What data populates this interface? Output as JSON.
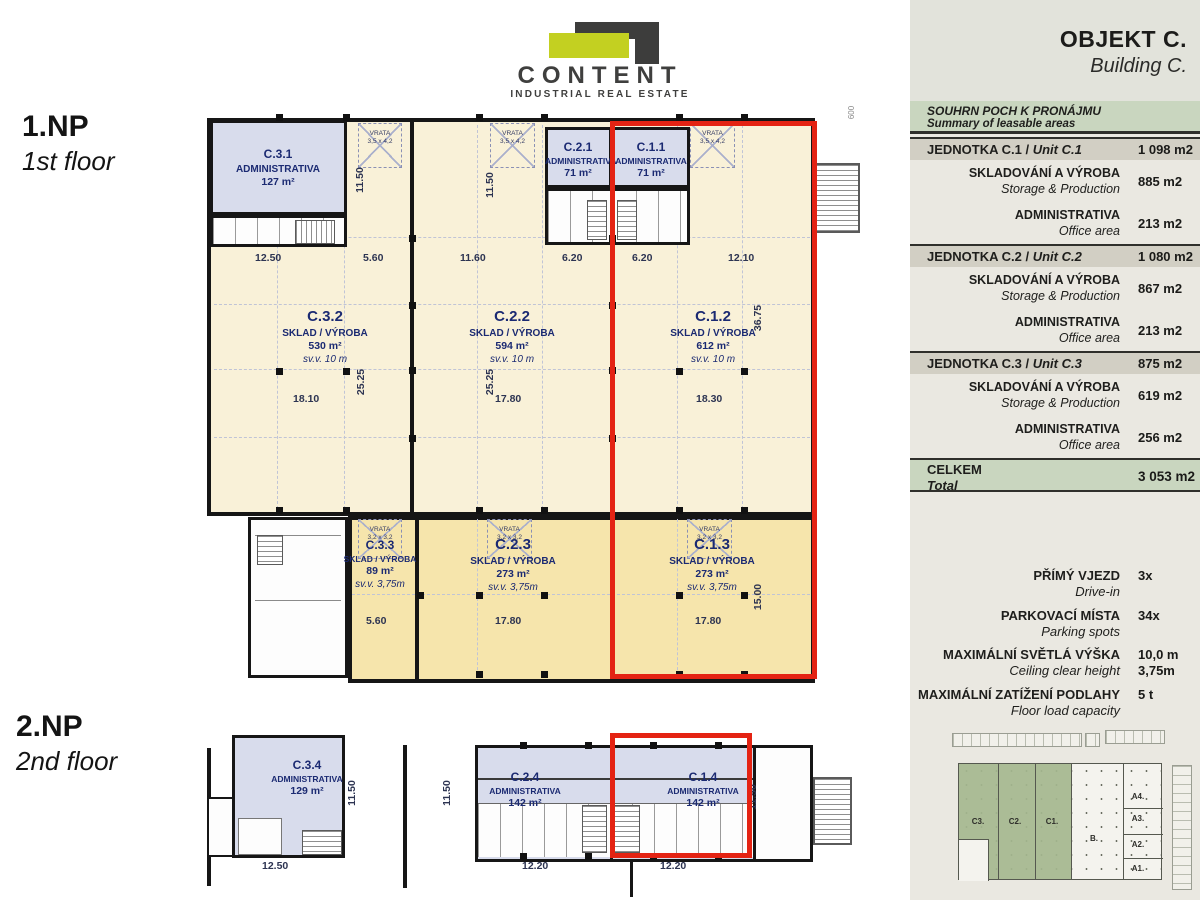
{
  "logo": {
    "name": "CONTENT",
    "tagline": "INDUSTRIAL REAL ESTATE"
  },
  "floor1": {
    "code": "1.NP",
    "label": "1st floor"
  },
  "floor2": {
    "code": "2.NP",
    "label": "2nd floor"
  },
  "plan1": {
    "rooms": {
      "c31": {
        "code": "C.3.1",
        "type": "ADMINISTRATIVA",
        "area": "127 m²"
      },
      "c21": {
        "code": "C.2.1",
        "type": "ADMINISTRATIVA",
        "area": "71 m²"
      },
      "c11": {
        "code": "C.1.1",
        "type": "ADMINISTRATIVA",
        "area": "71 m²"
      },
      "c32": {
        "code": "C.3.2",
        "type": "SKLAD / VÝROBA",
        "area": "530 m²",
        "height": "sv.v. 10 m"
      },
      "c22": {
        "code": "C.2.2",
        "type": "SKLAD / VÝROBA",
        "area": "594 m²",
        "height": "sv.v. 10 m"
      },
      "c12": {
        "code": "C.1.2",
        "type": "SKLAD / VÝROBA",
        "area": "612 m²",
        "height": "sv.v. 10 m"
      },
      "c33": {
        "code": "C.3.3",
        "type": "SKLAD / VÝROBA",
        "area": "89 m²",
        "height": "sv.v. 3,75m"
      },
      "c23": {
        "code": "C.2.3",
        "type": "SKLAD / VÝROBA",
        "area": "273 m²",
        "height": "sv.v. 3,75m"
      },
      "c13": {
        "code": "C.1.3",
        "type": "SKLAD / VÝROBA",
        "area": "273 m²",
        "height": "sv.v. 3,75m"
      }
    },
    "doors": {
      "label": "VRATA",
      "size_top": "3,5 x 4,2",
      "size_bottom": "3,2 x 3,2"
    },
    "dims": {
      "w1": "12.50",
      "w2": "5.60",
      "w3": "11.60",
      "w4": "6.20",
      "w5": "6.20",
      "w6": "12.10",
      "m1": "18.10",
      "m2": "17.80",
      "m3": "18.30",
      "b1": "5.60",
      "b2": "17.80",
      "b3": "17.80",
      "v1": "11.50",
      "v2": "11.50",
      "v3": "25.25",
      "v4": "25.25",
      "v5": "36.75",
      "v6": "15.00",
      "e1": "600"
    }
  },
  "plan2": {
    "rooms": {
      "c34": {
        "code": "C.3.4",
        "type": "ADMINISTRATIVA",
        "area": "129 m²"
      },
      "c24": {
        "code": "C.2.4",
        "type": "ADMINISTRATIVA",
        "area": "142 m²"
      },
      "c14": {
        "code": "C.1.4",
        "type": "ADMINISTRATIVA",
        "area": "142 m²"
      }
    },
    "dims": {
      "b1": "12.50",
      "b2": "12.20",
      "b3": "12.20",
      "v1": "11.50",
      "v2": "11.50",
      "v3": "11.50"
    }
  },
  "sidebar": {
    "title": "OBJEKT C.",
    "subtitle": "Building C.",
    "summary": {
      "cz": "SOUHRN POCH K PRONÁJMU",
      "en": "Summary of leasable areas"
    },
    "units": [
      {
        "cz": "JEDNOTKA C.1 /",
        "en": "Unit C.1",
        "total": "1 098 m2",
        "rows": [
          {
            "cz": "SKLADOVÁNÍ A VÝROBA",
            "en": "Storage & Production",
            "value": "885 m2"
          },
          {
            "cz": "ADMINISTRATIVA",
            "en": "Office area",
            "value": "213 m2"
          }
        ]
      },
      {
        "cz": "JEDNOTKA C.2 /",
        "en": "Unit C.2",
        "total": "1 080 m2",
        "rows": [
          {
            "cz": "SKLADOVÁNÍ A VÝROBA",
            "en": "Storage & Production",
            "value": "867 m2"
          },
          {
            "cz": "ADMINISTRATIVA",
            "en": "Office area",
            "value": "213 m2"
          }
        ]
      },
      {
        "cz": "JEDNOTKA C.3 /",
        "en": "Unit C.3",
        "total": "875 m2",
        "rows": [
          {
            "cz": "SKLADOVÁNÍ A VÝROBA",
            "en": "Storage & Production",
            "value": "619 m2"
          },
          {
            "cz": "ADMINISTRATIVA",
            "en": "Office area",
            "value": "256 m2"
          }
        ]
      }
    ],
    "total": {
      "cz": "CELKEM",
      "en": "Total",
      "value": "3 053 m2"
    },
    "specs": [
      {
        "cz": "PŘÍMÝ VJEZD",
        "en": "Drive-in",
        "value": "3x"
      },
      {
        "cz": "PARKOVACÍ MÍSTA",
        "en": "Parking spots",
        "value": "34x"
      },
      {
        "cz": "MAXIMÁLNÍ SVĚTLÁ VÝŠKA",
        "en": "Ceiling clear height",
        "value": "10,0 m",
        "value2": "3,75m"
      },
      {
        "cz": "MAXIMÁLNÍ ZATÍŽENÍ PODLAHY",
        "en": "Floor load capacity",
        "value": "5 t"
      }
    ],
    "siteplan": {
      "c3": "C3.",
      "c2": "C2.",
      "c1": "C1.",
      "b": "B.",
      "a4": "A4.",
      "a3": "A3.",
      "a2": "A2.",
      "a1": "A1."
    }
  },
  "colors": {
    "accent_red": "#e42313",
    "brand_yellow": "#c3d021",
    "brand_dark": "#3d3d3c",
    "admin_fill": "#d8dcec",
    "hall_fill": "#f9f1d8",
    "hall_lower_fill": "#f6e5ac",
    "green_band": "#c9d6bf",
    "site_green": "#a4b78e"
  }
}
